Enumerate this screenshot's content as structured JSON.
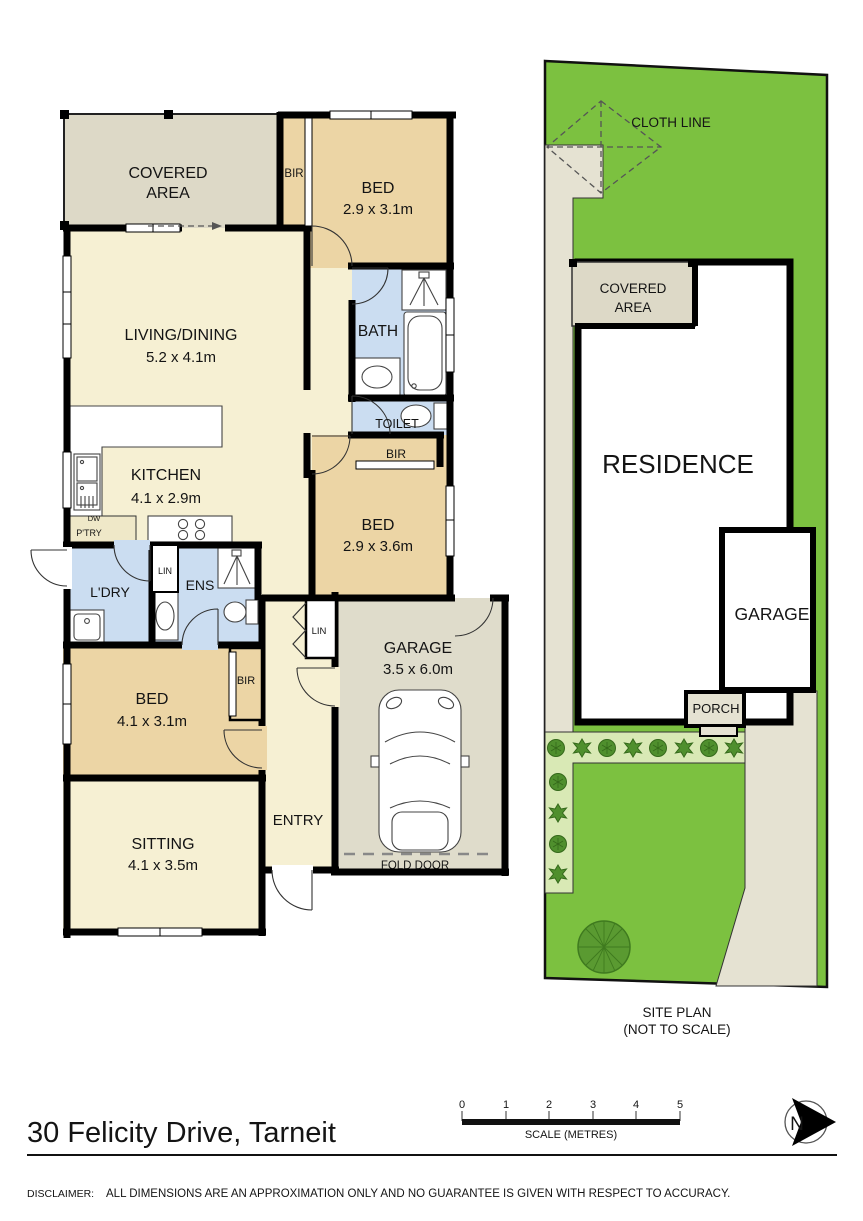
{
  "colors": {
    "wall": "#000000",
    "floor_cream": "#F6F0D3",
    "floor_tan": "#ECD5A5",
    "floor_wet": "#CBDDF1",
    "floor_covered": "#DDD9C7",
    "floor_garage": "#DFDCCB",
    "lawn": "#7CC140",
    "garden_bed": "#D9E9B5",
    "paving": "#E5E2D2",
    "plant": "#4F8F2D",
    "tree": "#5A9A31"
  },
  "floor_plan": {
    "covered_area": {
      "l1": "COVERED",
      "l2": "AREA"
    },
    "bir_top": "BIR",
    "bed1": {
      "name": "BED",
      "dims": "2.9 x 3.1m"
    },
    "living": {
      "name": "LIVING/DINING",
      "dims": "5.2 x 4.1m"
    },
    "bath": "BATH",
    "toilet": "TOILET",
    "bir_mid": "BIR",
    "bed2": {
      "name": "BED",
      "dims": "2.9 x 3.6m"
    },
    "kitchen": {
      "name": "KITCHEN",
      "dims": "4.1 x 2.9m"
    },
    "dw": "DW",
    "pantry": "P'TRY",
    "laundry": "L'DRY",
    "linen1": "LIN",
    "ensuite": "ENS",
    "bed3": {
      "name": "BED",
      "dims": "4.1 x 3.1m"
    },
    "bir3": "BIR",
    "linen2": "LIN",
    "sitting": {
      "name": "SITTING",
      "dims": "4.1 x 3.5m"
    },
    "entry": "ENTRY",
    "garage": {
      "name": "GARAGE",
      "dims": "3.5 x 6.0m"
    },
    "fold_door": "FOLD DOOR"
  },
  "site_plan": {
    "cloth_line": "CLOTH LINE",
    "covered_area": {
      "l1": "COVERED",
      "l2": "AREA"
    },
    "residence": "RESIDENCE",
    "garage": "GARAGE",
    "porch": "PORCH",
    "caption_line1": "SITE PLAN",
    "caption_line2": "(NOT TO SCALE)"
  },
  "footer": {
    "address": "30 Felicity Drive, Tarneit",
    "scale_ticks": [
      "0",
      "1",
      "2",
      "3",
      "4",
      "5"
    ],
    "scale_label": "SCALE (METRES)",
    "north_label": "N",
    "disclaimer_label": "DISCLAIMER:",
    "disclaimer_text": "ALL DIMENSIONS ARE AN APPROXIMATION ONLY AND NO GUARANTEE IS GIVEN WITH RESPECT TO ACCURACY."
  }
}
